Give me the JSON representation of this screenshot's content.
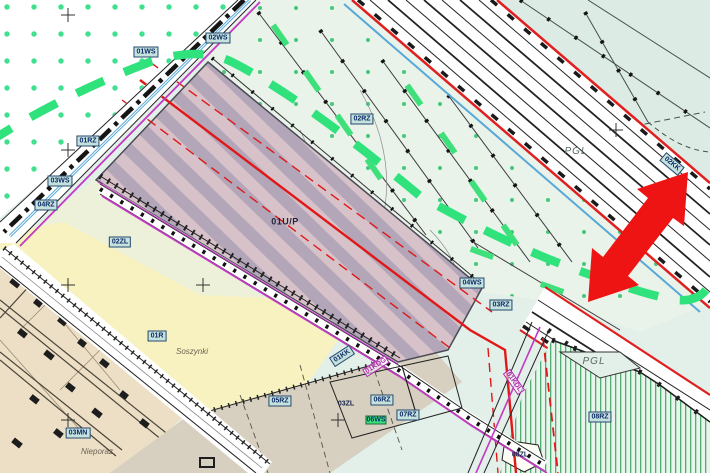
{
  "map_type": "zoning-plan-map",
  "labels": [
    {
      "text": "01WS"
    },
    {
      "text": "02WS"
    },
    {
      "text": "01RZ"
    },
    {
      "text": "03WS"
    },
    {
      "text": "04RZ"
    },
    {
      "text": "02ZL"
    },
    {
      "text": "02RZ"
    },
    {
      "text": "01U/P"
    },
    {
      "text": "01R"
    },
    {
      "text": "Soszynki"
    },
    {
      "text": "03MN"
    },
    {
      "text": "Nieporaz"
    },
    {
      "text": "05RZ"
    },
    {
      "text": "03ZL"
    },
    {
      "text": "06RZ"
    },
    {
      "text": "06WS"
    },
    {
      "text": "07RZ"
    },
    {
      "text": "01KK"
    },
    {
      "text": "01KDG"
    },
    {
      "text": "04WS"
    },
    {
      "text": "03RZ"
    },
    {
      "text": "08RZ"
    },
    {
      "text": "08ZL"
    },
    {
      "text": "PGL"
    },
    {
      "text": "PGL"
    },
    {
      "text": "02KK"
    },
    {
      "text": "01KDL"
    }
  ],
  "colors": {
    "hatch_mauve": "#b2a6b8",
    "hatch_pink": "#d8c2c9",
    "green_boundary_dash": "#30e27c",
    "red_line": "#e01818",
    "arrow_red": "#ee1414",
    "magenta_utility": "#c23ac2",
    "water_blue": "#58a8d8",
    "yellow_zone": "#f7f2c0",
    "tan_zone": "#ecdfc6",
    "gray_zone": "#d7cfc0",
    "teal_zone": "#dcebe4",
    "light_green_zone": "#e9f3ea",
    "dot_green": "#3fe08e"
  }
}
